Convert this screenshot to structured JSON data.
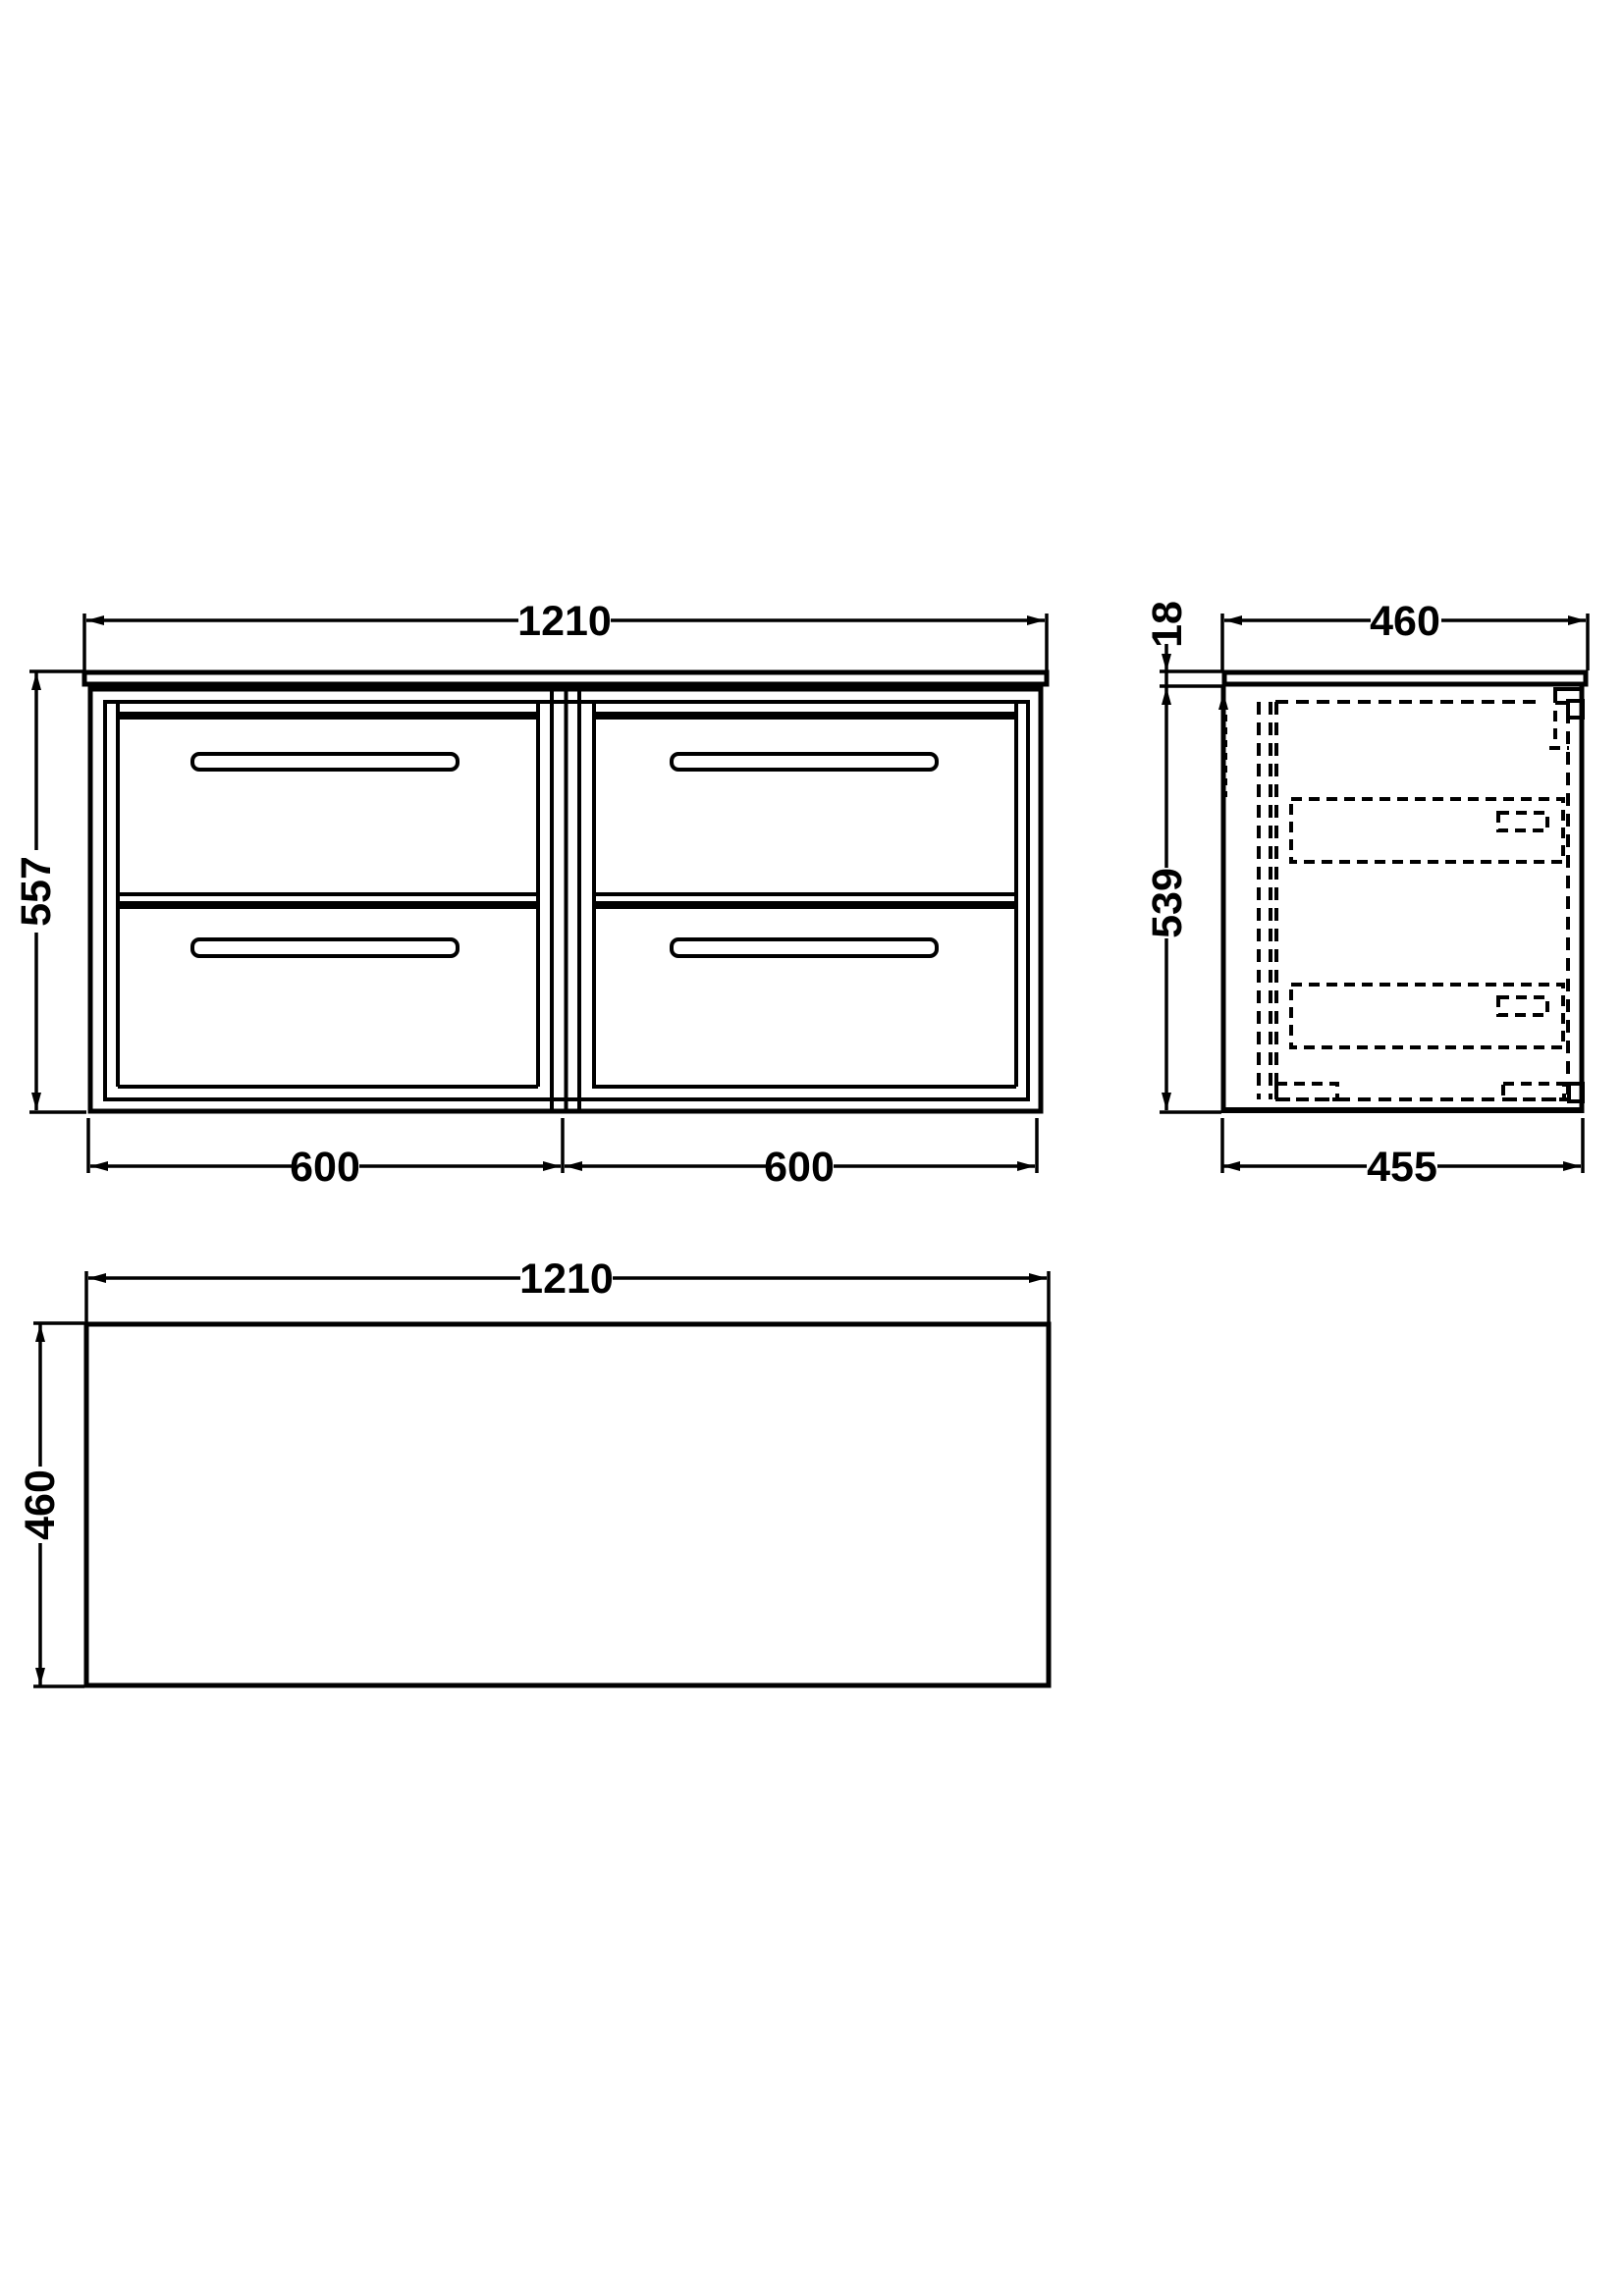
{
  "front_view": {
    "width_label": "1210",
    "height_label": "557",
    "left_section_label": "600",
    "right_section_label": "600"
  },
  "side_view": {
    "depth_label": "460",
    "worktop_thickness_label": "18",
    "cabinet_height_label": "539",
    "cabinet_depth_label": "455"
  },
  "plan_view": {
    "width_label": "1210",
    "depth_label": "460"
  },
  "colors": {
    "line": "#000000",
    "background": "#ffffff"
  }
}
